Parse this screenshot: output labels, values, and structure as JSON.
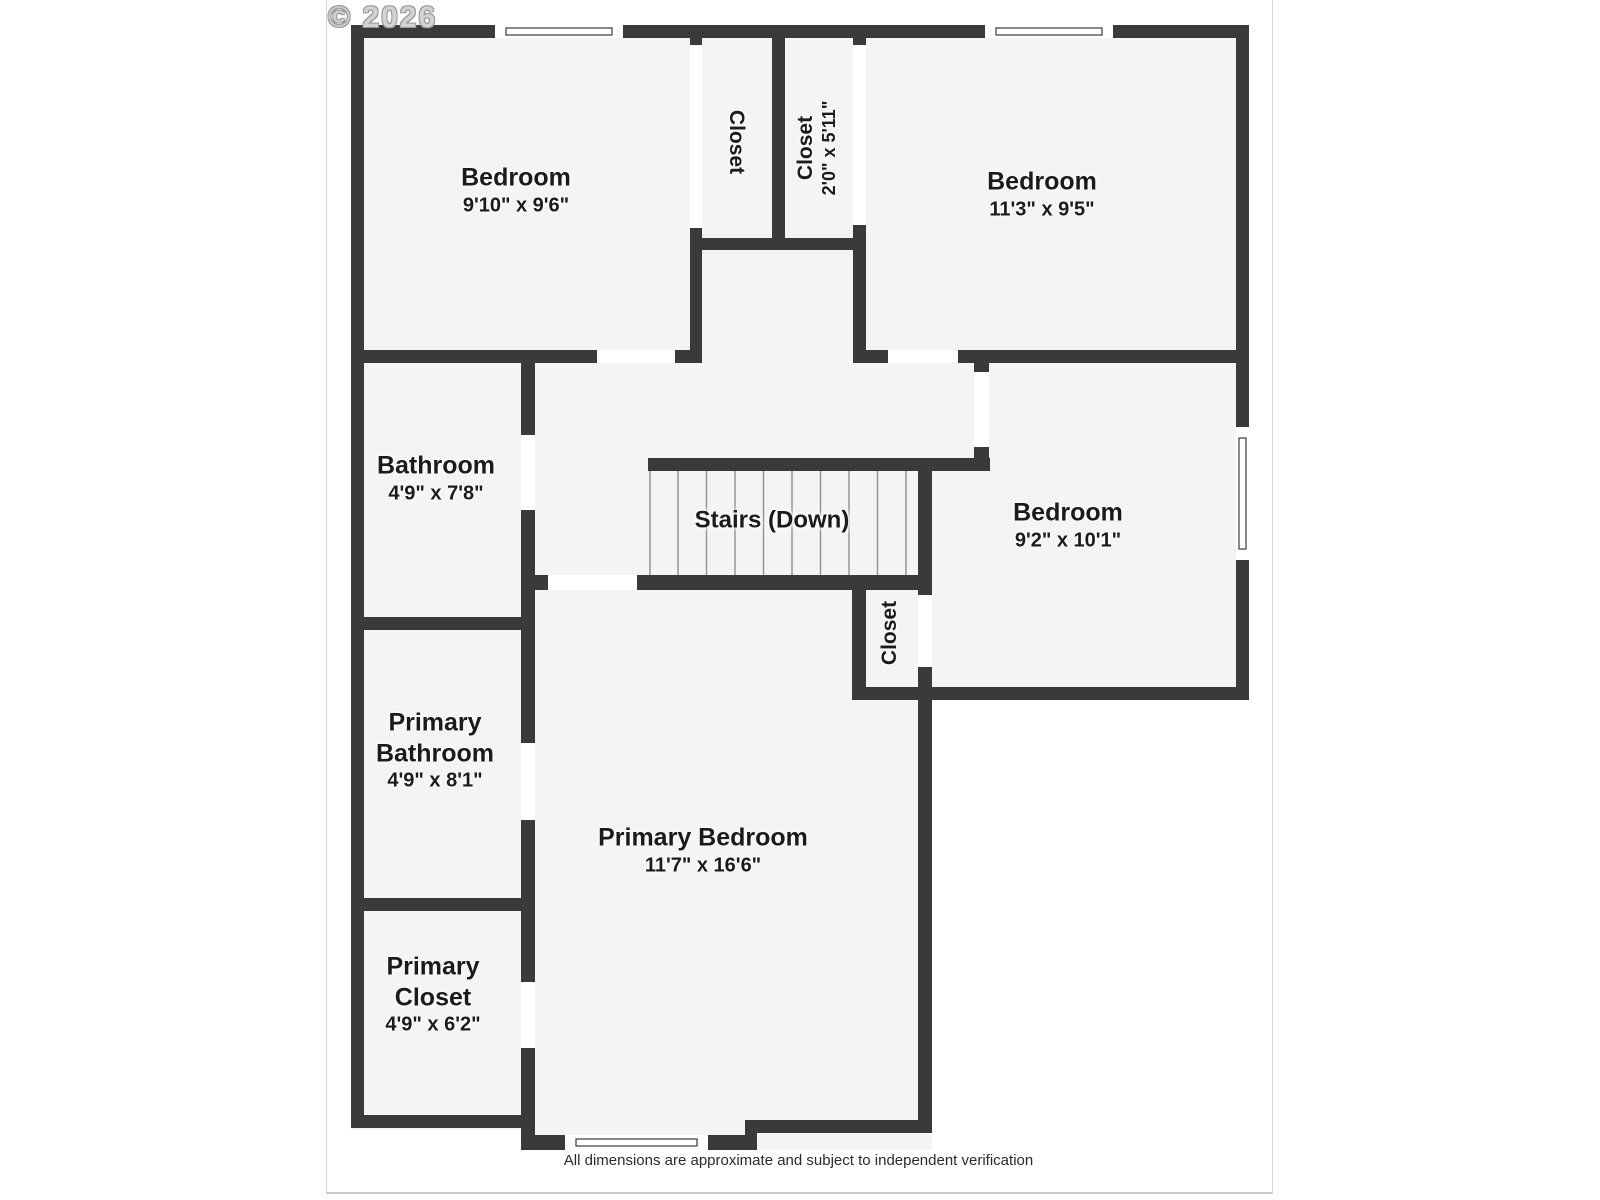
{
  "watermark": "© 2026",
  "footer": "All dimensions are approximate and subject to independent verification",
  "rooms": {
    "bedroom1": {
      "name": "Bedroom",
      "dims": "9'10\" x 9'6\""
    },
    "closet1": {
      "name": "Closet",
      "dims": ""
    },
    "closet2": {
      "name": "Closet",
      "dims": "2'0\" x 5'11\""
    },
    "bedroom2": {
      "name": "Bedroom",
      "dims": "11'3\" x 9'5\""
    },
    "bathroom": {
      "name": "Bathroom",
      "dims": "4'9\" x 7'8\""
    },
    "stairs": {
      "name": "Stairs (Down)",
      "dims": ""
    },
    "bedroom3": {
      "name": "Bedroom",
      "dims": "9'2\" x 10'1\""
    },
    "closet3": {
      "name": "Closet",
      "dims": ""
    },
    "primary_bathroom": {
      "name": "Primary Bathroom",
      "dims": "4'9\" x 8'1\""
    },
    "primary_closet": {
      "name": "Primary Closet",
      "dims": "4'9\" x 6'2\""
    },
    "primary_bedroom": {
      "name": "Primary Bedroom",
      "dims": "11'7\" x 16'6\""
    }
  },
  "colors": {
    "wall": "#3a3a3c",
    "floor": "#f4f4f5",
    "opening": "#ffffff",
    "text": "#1b1b1d",
    "watermark": "#d2d2d2",
    "frame": "#d6d6d6",
    "tread": "#8f8f8f"
  }
}
